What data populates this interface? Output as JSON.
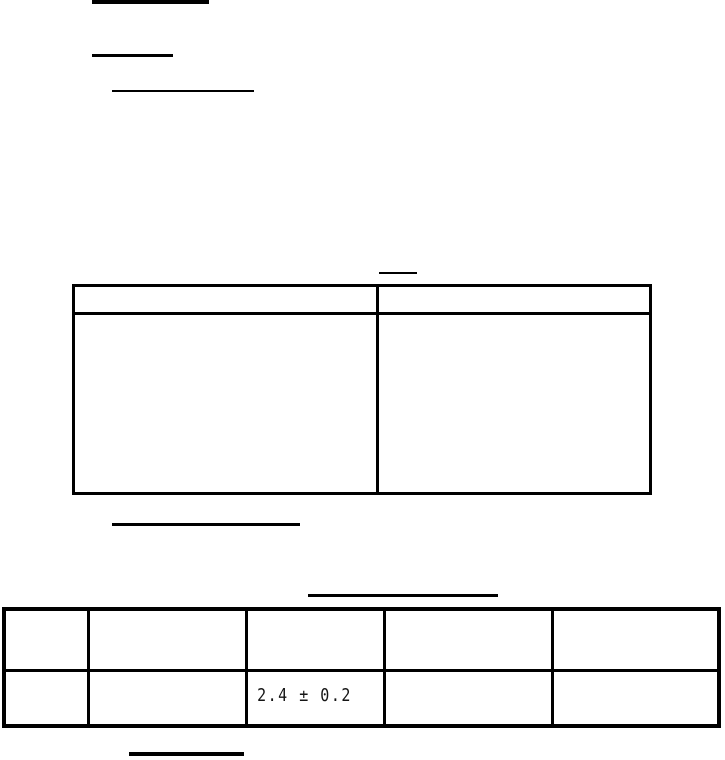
{
  "page": {
    "background_color": "#ffffff",
    "line_color": "#000000",
    "text_color": "#151515"
  },
  "table1": {
    "columns": 2,
    "header": [
      "",
      ""
    ],
    "rows": [
      [
        "",
        ""
      ]
    ]
  },
  "table2": {
    "columns": 5,
    "header": [
      "",
      "",
      "",
      "",
      ""
    ],
    "rows": [
      [
        "",
        "",
        "2.4 ± 0.2",
        "",
        ""
      ]
    ]
  }
}
